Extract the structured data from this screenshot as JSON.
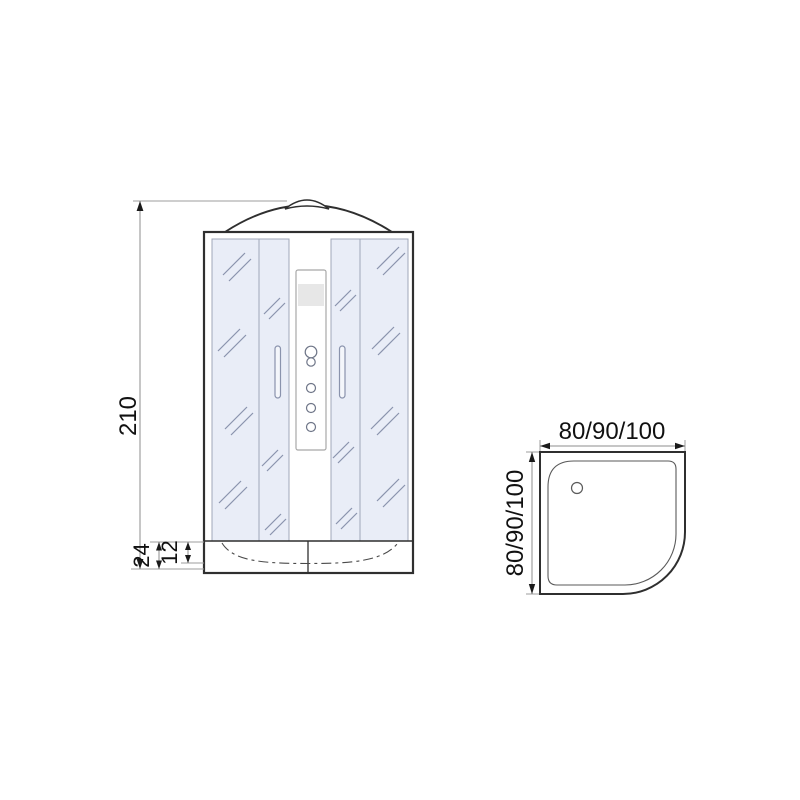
{
  "colors": {
    "glass_fill": "#e9edf7",
    "outline": "#2f2f2f",
    "dimension_text": "#111111"
  },
  "front_view": {
    "height_label": "210",
    "tray_height_label": "24",
    "tray_depth_label": "12"
  },
  "top_view": {
    "width_label": "80/90/100",
    "depth_label": "80/90/100"
  }
}
